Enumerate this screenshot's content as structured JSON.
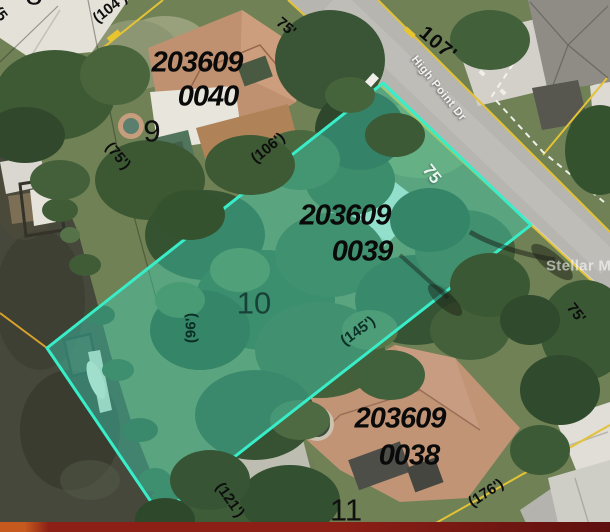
{
  "meta": {
    "description": "Aerial parcel map with highlighted lot",
    "width": 610,
    "height": 532
  },
  "colors": {
    "highlight_fill": "rgba(61,214,189,0.42)",
    "highlight_border": "#38eec9",
    "parcel_line_yellow": "#e3c235",
    "parcel_line_orange": "#d9a02c",
    "dashed_line_white": "#f4f4ee",
    "watermark_white": "rgba(255,255,255,0.58)",
    "bottom_bar": [
      "#c65a1e",
      "#8c2016",
      "#5e100f"
    ]
  },
  "street": {
    "name": "High Point Dr",
    "number_label": "107'"
  },
  "watermark_text": "Stellar MLS",
  "parcels": [
    {
      "parcel_id": "203609 0040",
      "lot_number": "9",
      "highlighted": false
    },
    {
      "parcel_id": "203609 0039",
      "lot_number": "10",
      "highlighted": true
    },
    {
      "parcel_id": "203609 0038",
      "lot_number": "11",
      "highlighted": false
    }
  ],
  "labels": [
    {
      "name": "lot-8-number",
      "text": "8",
      "x": 34,
      "y": -6,
      "rot": 0,
      "cls": "lot-num"
    },
    {
      "name": "dim-fragment-edge",
      "text": "(5",
      "x": 0,
      "y": 14,
      "rot": 52,
      "cls": "dim"
    },
    {
      "name": "dim-104",
      "text": "(104')",
      "x": 110,
      "y": 8,
      "rot": -38,
      "cls": "dim"
    },
    {
      "name": "dim-75-top",
      "text": "75'",
      "x": 286,
      "y": 27,
      "rot": 40,
      "cls": "dim"
    },
    {
      "name": "road-number-107",
      "text": "107'",
      "x": 438,
      "y": 44,
      "rot": 40,
      "cls": "road-num"
    },
    {
      "name": "street-name",
      "text": "High Point Dr",
      "x": 438,
      "y": 89,
      "rot": 51,
      "cls": "street"
    },
    {
      "name": "parcel-0040-line1",
      "text": "203609",
      "x": 197,
      "y": 63,
      "rot": 0,
      "cls": "parcel-id"
    },
    {
      "name": "parcel-0040-line2",
      "text": "0040",
      "x": 208,
      "y": 97,
      "rot": 0,
      "cls": "parcel-id"
    },
    {
      "name": "lot-9-number",
      "text": "9",
      "x": 152,
      "y": 131,
      "rot": 0,
      "cls": "lot-num"
    },
    {
      "name": "dim-75-lot9",
      "text": "(75')",
      "x": 118,
      "y": 156,
      "rot": 50,
      "cls": "dim"
    },
    {
      "name": "dim-106",
      "text": "(106')",
      "x": 268,
      "y": 148,
      "rot": -39,
      "cls": "dim"
    },
    {
      "name": "dim-75-frontage",
      "text": "75",
      "x": 432,
      "y": 174,
      "rot": 52,
      "cls": "dim-white"
    },
    {
      "name": "parcel-0039-line1",
      "text": "203609",
      "x": 345,
      "y": 216,
      "rot": 0,
      "cls": "parcel-id"
    },
    {
      "name": "parcel-0039-line2",
      "text": "0039",
      "x": 362,
      "y": 252,
      "rot": 0,
      "cls": "parcel-id"
    },
    {
      "name": "lot-10-number",
      "text": "10",
      "x": 254,
      "y": 303,
      "rot": 0,
      "cls": "lot-num lot-num-hl"
    },
    {
      "name": "dim-96",
      "text": "(96')",
      "x": 191,
      "y": 328,
      "rot": -90,
      "cls": "dim dim-hl"
    },
    {
      "name": "dim-145",
      "text": "(145')",
      "x": 358,
      "y": 331,
      "rot": -36,
      "cls": "dim dim-hl"
    },
    {
      "name": "stellar-mls-watermark",
      "text": "Stellar MLS",
      "x": 546,
      "y": 266,
      "rot": 0,
      "cls": "watermark",
      "anchor": "left"
    },
    {
      "name": "dim-75-right",
      "text": "75'",
      "x": 576,
      "y": 313,
      "rot": 52,
      "cls": "dim"
    },
    {
      "name": "parcel-0038-line1",
      "text": "203609",
      "x": 400,
      "y": 419,
      "rot": 0,
      "cls": "parcel-id"
    },
    {
      "name": "parcel-0038-line2",
      "text": "0038",
      "x": 409,
      "y": 456,
      "rot": 0,
      "cls": "parcel-id"
    },
    {
      "name": "lot-11-number",
      "text": "11",
      "x": 346,
      "y": 510,
      "rot": 0,
      "cls": "lot-num"
    },
    {
      "name": "dim-176",
      "text": "(176')",
      "x": 486,
      "y": 493,
      "rot": -33,
      "cls": "dim"
    },
    {
      "name": "dim-121",
      "text": "(121')",
      "x": 230,
      "y": 500,
      "rot": 55,
      "cls": "dim"
    }
  ]
}
